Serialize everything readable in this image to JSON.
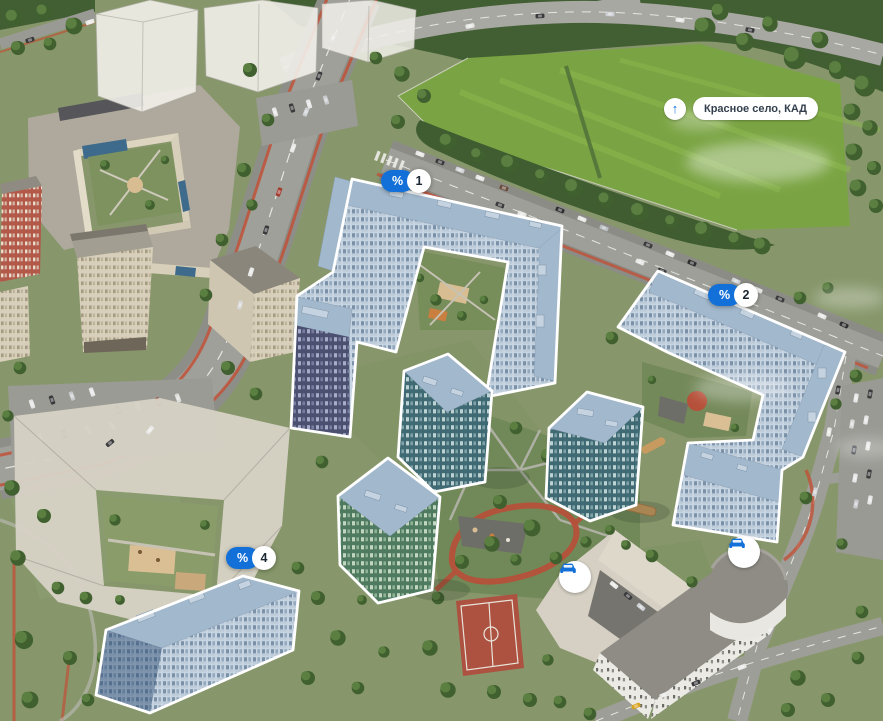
{
  "map": {
    "direction_label": {
      "icon": "arrow-up",
      "text": "Красное село, КАД"
    },
    "markers": [
      {
        "symbol": "%",
        "number": "1"
      },
      {
        "symbol": "%",
        "number": "2"
      },
      {
        "symbol": "%",
        "number": "4"
      }
    ],
    "poi": [
      {
        "icon": "car"
      },
      {
        "icon": "car"
      }
    ],
    "colors": {
      "accent": "#1270d8",
      "marker_number_text": "#1b2733",
      "label_text": "#333f4c",
      "highlight_outline": "#ffffff"
    }
  }
}
